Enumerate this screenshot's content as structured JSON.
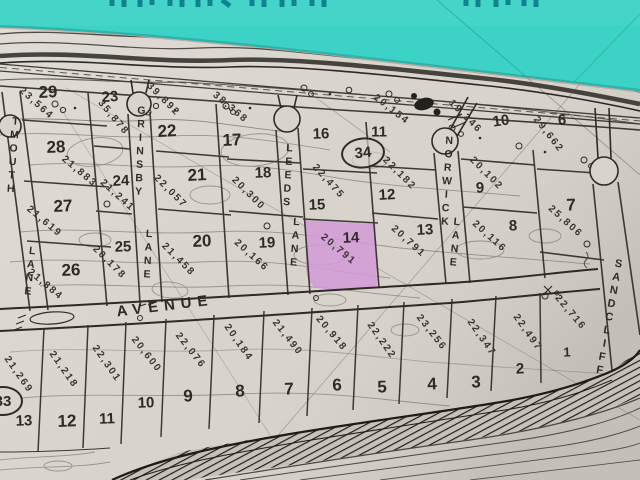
{
  "colors": {
    "water": "#3cd2c6",
    "paper": "#d8d3cb",
    "ink": "#2e2b26",
    "highlight": "#d49ad8"
  },
  "streets": {
    "avenue": "AVENUE",
    "left_lane": "TMOUTH",
    "left_lane_suffix": "LANE",
    "grinsby": "GRINSBY",
    "grinsby_suffix": "LANE",
    "leeds": "LEEDS",
    "leeds_suffix": "LANE",
    "norwick": "NORWICK",
    "norwick_suffix": "LANE",
    "sandcliff": "SANDCLIFF"
  },
  "blocks": {
    "center_oval": "34",
    "southwest_oval": "33"
  },
  "highlighted_lot": "14",
  "upper_lots": [
    {
      "num": "29",
      "area": "23,564"
    },
    {
      "num": "23",
      "area": "35,878"
    },
    {
      "num": "22",
      "area": "39,892"
    },
    {
      "num": "17",
      "area": "38,368"
    },
    {
      "num": "16"
    },
    {
      "num": "11",
      "area": "20,154"
    },
    {
      "num": "10",
      "area": "19,346"
    },
    {
      "num": "6",
      "area": "29,662"
    },
    {
      "num": "28",
      "area": "21,883"
    },
    {
      "num": "24",
      "area": "21,241"
    },
    {
      "num": "21",
      "area": "22,057"
    },
    {
      "num": "18",
      "area": "20,300"
    },
    {
      "num": "12",
      "area": "22,182"
    },
    {
      "num": "9",
      "area": "20,102"
    },
    {
      "num": "7",
      "area": "25,806"
    },
    {
      "num": "27",
      "area": "21,619"
    },
    {
      "num": "25",
      "area": "20,178"
    },
    {
      "num": "26",
      "area": "21,884"
    },
    {
      "num": "20",
      "area": "21,458"
    },
    {
      "num": "19",
      "area": "20,166"
    },
    {
      "num": "15",
      "area": "22,475"
    },
    {
      "num": "14",
      "area": "20,791",
      "highlighted": true
    },
    {
      "num": "13",
      "area": "20,791"
    },
    {
      "num": "8",
      "area": "20,116"
    }
  ],
  "lower_lots": [
    {
      "num": "13",
      "area": "21,269"
    },
    {
      "num": "12",
      "area": "21,218"
    },
    {
      "num": "11",
      "area": "22,301"
    },
    {
      "num": "10",
      "area": "20,600"
    },
    {
      "num": "9",
      "area": "22,076"
    },
    {
      "num": "8",
      "area": "20,184"
    },
    {
      "num": "7",
      "area": "21,490"
    },
    {
      "num": "6",
      "area": "20,918"
    },
    {
      "num": "5",
      "area": "22,222"
    },
    {
      "num": "4",
      "area": "23,256"
    },
    {
      "num": "3",
      "area": "22,347"
    },
    {
      "num": "2",
      "area": "22,497"
    },
    {
      "num": "1",
      "area": "22,716"
    }
  ]
}
